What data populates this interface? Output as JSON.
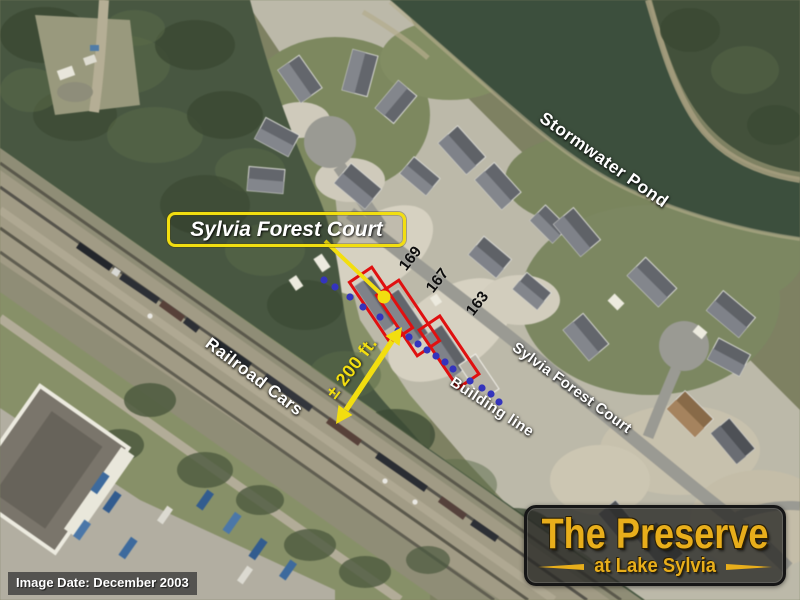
{
  "callout": {
    "label": "Sylvia Forest Court"
  },
  "map_labels": {
    "pond": "Stormwater Pond",
    "railroad": "Railroad Cars",
    "distance": "± 200 ft.",
    "building_line": "Building line",
    "street": "Sylvia Forest Court"
  },
  "lots": [
    "169",
    "167",
    "163"
  ],
  "logo": {
    "title": "The Preserve",
    "subtitle": "at Lake Sylvia"
  },
  "footer": {
    "image_date": "Image Date: December 2003"
  },
  "colors": {
    "annotation_yellow": "#f2de10",
    "lot_outline_red": "#e01010",
    "building_line_blue": "#3434bd",
    "logo_gold": "#e8ae1b"
  }
}
